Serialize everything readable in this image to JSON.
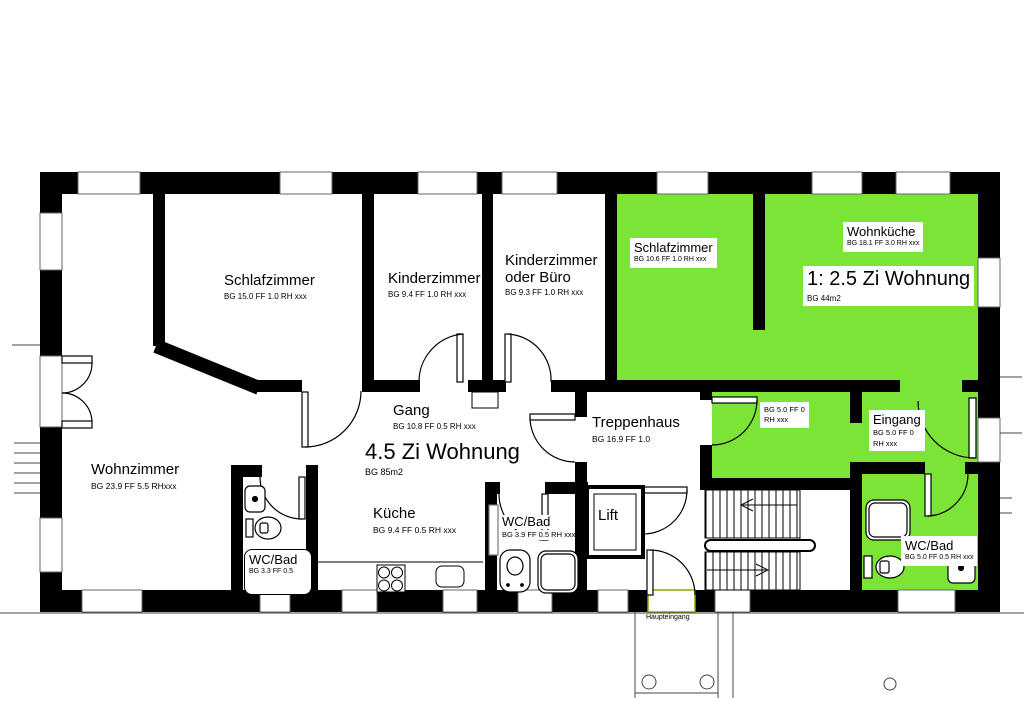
{
  "plan": {
    "colors": {
      "apartment2_fill": "#7ce437",
      "wall": "#000000",
      "entrance_marker": "#9aa000"
    },
    "apartment_45": {
      "title": "4.5 Zi Wohnung",
      "area": "BG 85m2"
    },
    "apartment_25": {
      "title": "1: 2.5 Zi Wohnung",
      "area": "BG 44m2"
    },
    "rooms": {
      "schlafzimmer_45": {
        "name": "Schlafzimmer",
        "info": "BG 15.0 FF 1.0 RH xxx"
      },
      "kinderzimmer": {
        "name": "Kinderzimmer",
        "info": "BG 9.4 FF 1.0 RH xxx"
      },
      "kinderzimmer_buero": {
        "name": "Kinderzimmer oder Büro",
        "info": "BG 9.3 FF 1.0 RH xxx"
      },
      "wohnzimmer": {
        "name": "Wohnzimmer",
        "info": "BG 23.9 FF 5.5 RHxxx"
      },
      "gang": {
        "name": "Gang",
        "info": "BG 10.8 FF 0.5 RH xxx"
      },
      "kueche": {
        "name": "Küche",
        "info": "BG 9.4 FF 0.5 RH xxx"
      },
      "wc_bad_klein": {
        "name": "WC/Bad",
        "info": "BG 3.3 FF 0.5"
      },
      "wc_bad_gang": {
        "name": "WC/Bad",
        "info": "BG 3.9  FF 0.5 RH xxx"
      },
      "treppenhaus": {
        "name": "Treppenhaus",
        "info": "BG 16.9 FF 1.0"
      },
      "lift": {
        "name": "Lift"
      },
      "schlafzimmer_25": {
        "name": "Schlafzimmer",
        "info": "BG 10.6 FF 1.0 RH xxx"
      },
      "wohnkueche": {
        "name": "Wohnküche",
        "info": "BG 18.1 FF 3.0 RH xxx"
      },
      "vorraum": {
        "info_line1": "BG 5.0 FF 0",
        "info_line2": "RH xxx"
      },
      "eingang": {
        "name": "Eingang",
        "info_line1": "BG 5.0 FF 0",
        "info_line2": "RH xxx"
      },
      "wc_bad_25": {
        "name": "WC/Bad",
        "info": "BG 5.0 FF 0.5 RH xxx"
      }
    },
    "annotations": {
      "main_entrance_label": "Haupteingang"
    }
  }
}
